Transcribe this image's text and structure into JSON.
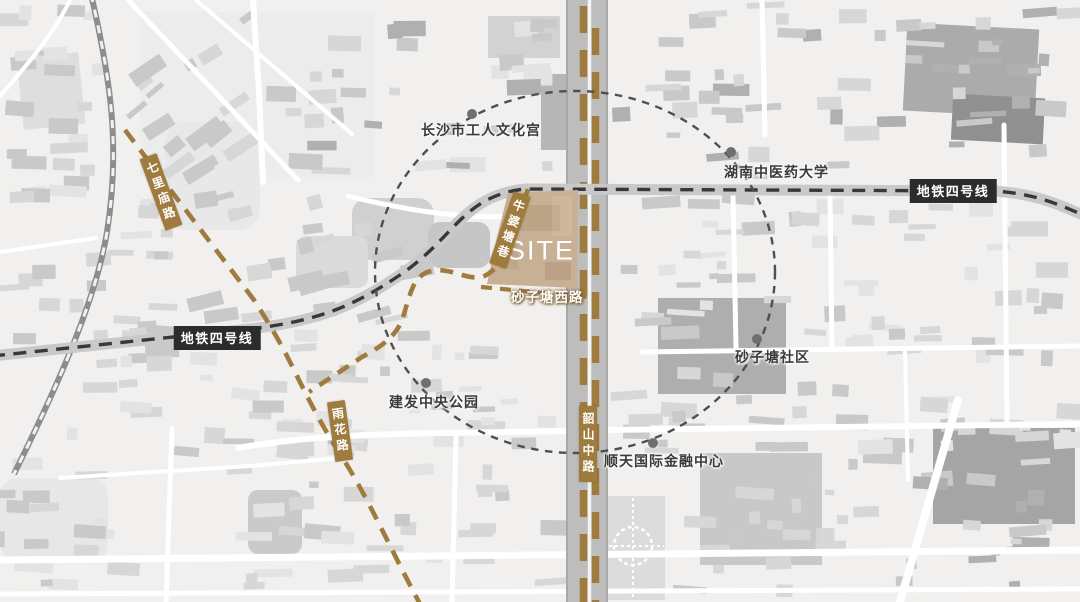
{
  "site": {
    "label": "SITE"
  },
  "road_badges": {
    "qilimiao": "七里庙路",
    "niupotang": "牛婆塘巷",
    "yuhua": "雨花路",
    "shaoshan": "韶山中路",
    "shazitang_west": "砂子塘西路"
  },
  "metro_badges": {
    "left": "地铁四号线",
    "right": "地铁四号线"
  },
  "landmarks": {
    "cultural_palace": "长沙市工人文化宫",
    "tcm_university": "湖南中医药大学",
    "shazitang_community": "砂子塘社区",
    "shuntian_ifc": "顺天国际金融中心",
    "jianfa_central_park": "建发中央公园"
  },
  "colors": {
    "accent_brown": "#9f7b3e",
    "site_fill": "#c8b094",
    "metro_badge_dark": "#2c2c2c",
    "label_text": "#3a3a3a"
  }
}
